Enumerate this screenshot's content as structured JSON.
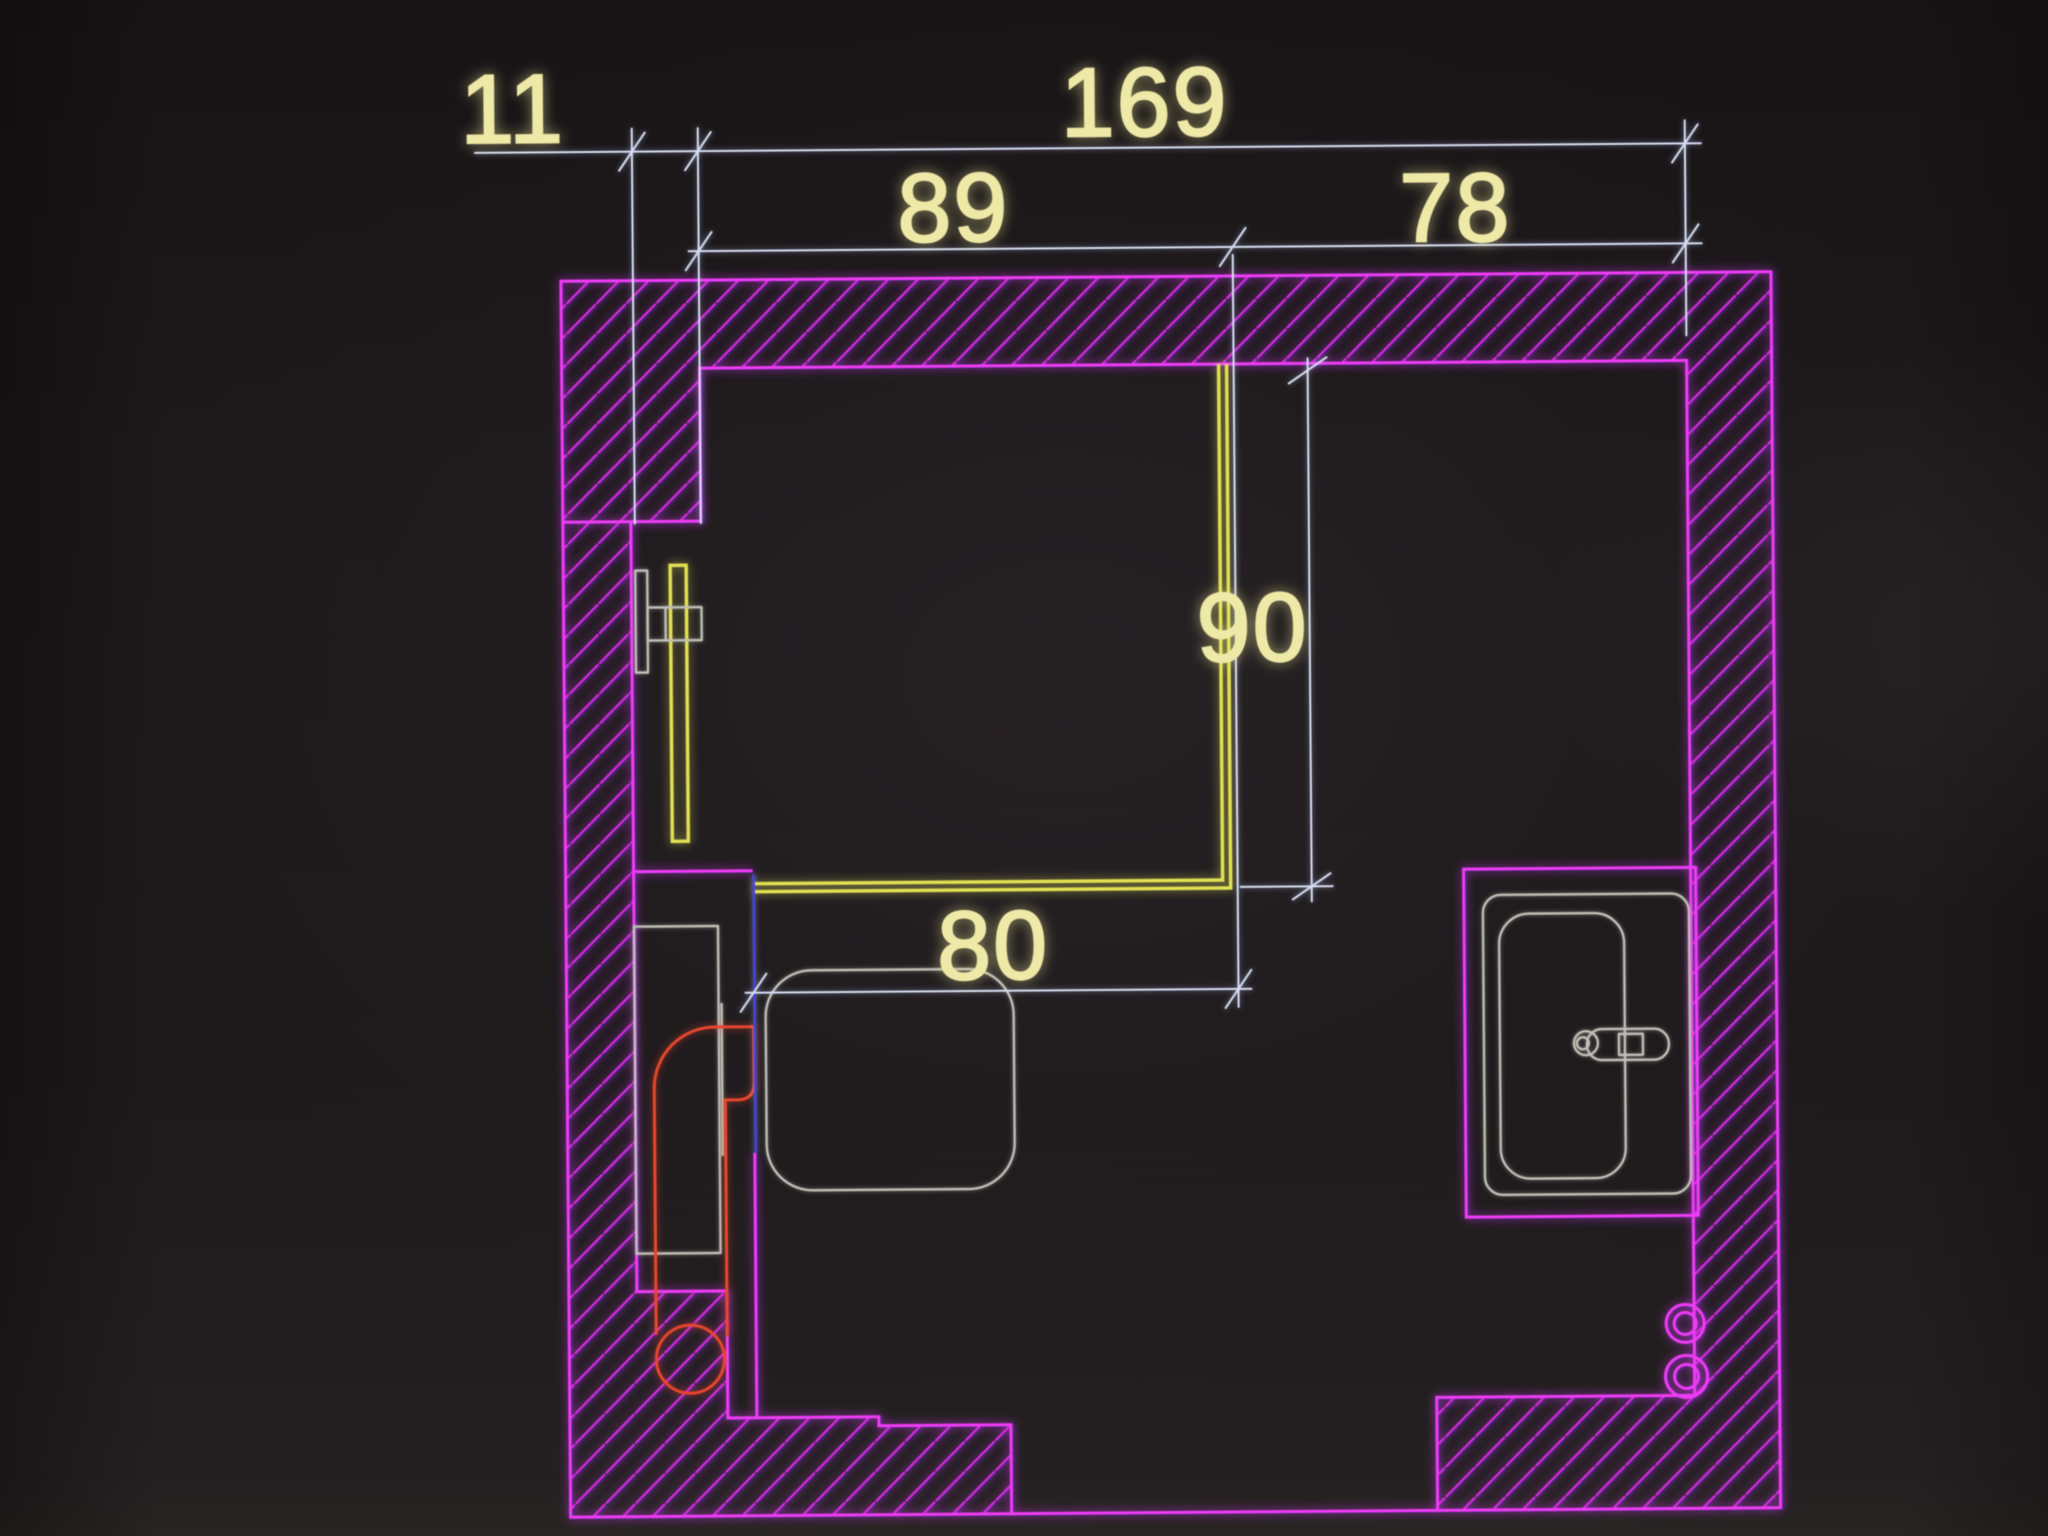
{
  "scene": {
    "description": "Photograph of a monitor displaying a CAD bathroom floor plan on a black background",
    "drawing_type": "architectural plan view with dimension chains"
  },
  "dimensions": {
    "pier_width": "11",
    "interior_width": "169",
    "shower_zone_width": "89",
    "basin_zone_width": "78",
    "shower_depth": "90",
    "wc_zone_width": "80"
  },
  "fixtures": [
    "hatched-masonry-walls",
    "shower-glass-enclosure",
    "towel-radiator",
    "toilet-cistern",
    "toilet-bowl",
    "floor-drain",
    "supply-pipes",
    "vanity-counter",
    "washbasin",
    "faucet",
    "wall-pipe-sleeves",
    "door-opening-threshold"
  ],
  "colors": {
    "wall": "#ee3cf4",
    "hatch": "#d92ce0",
    "dim_line": "#d7def2",
    "dim_text": "#efe9a8",
    "fixture": "#bfc0b6",
    "plumbing": "#e8462e",
    "glass_yellow": "#e2e253",
    "ext_blue": "#4644e0",
    "background": "#1d191b"
  }
}
